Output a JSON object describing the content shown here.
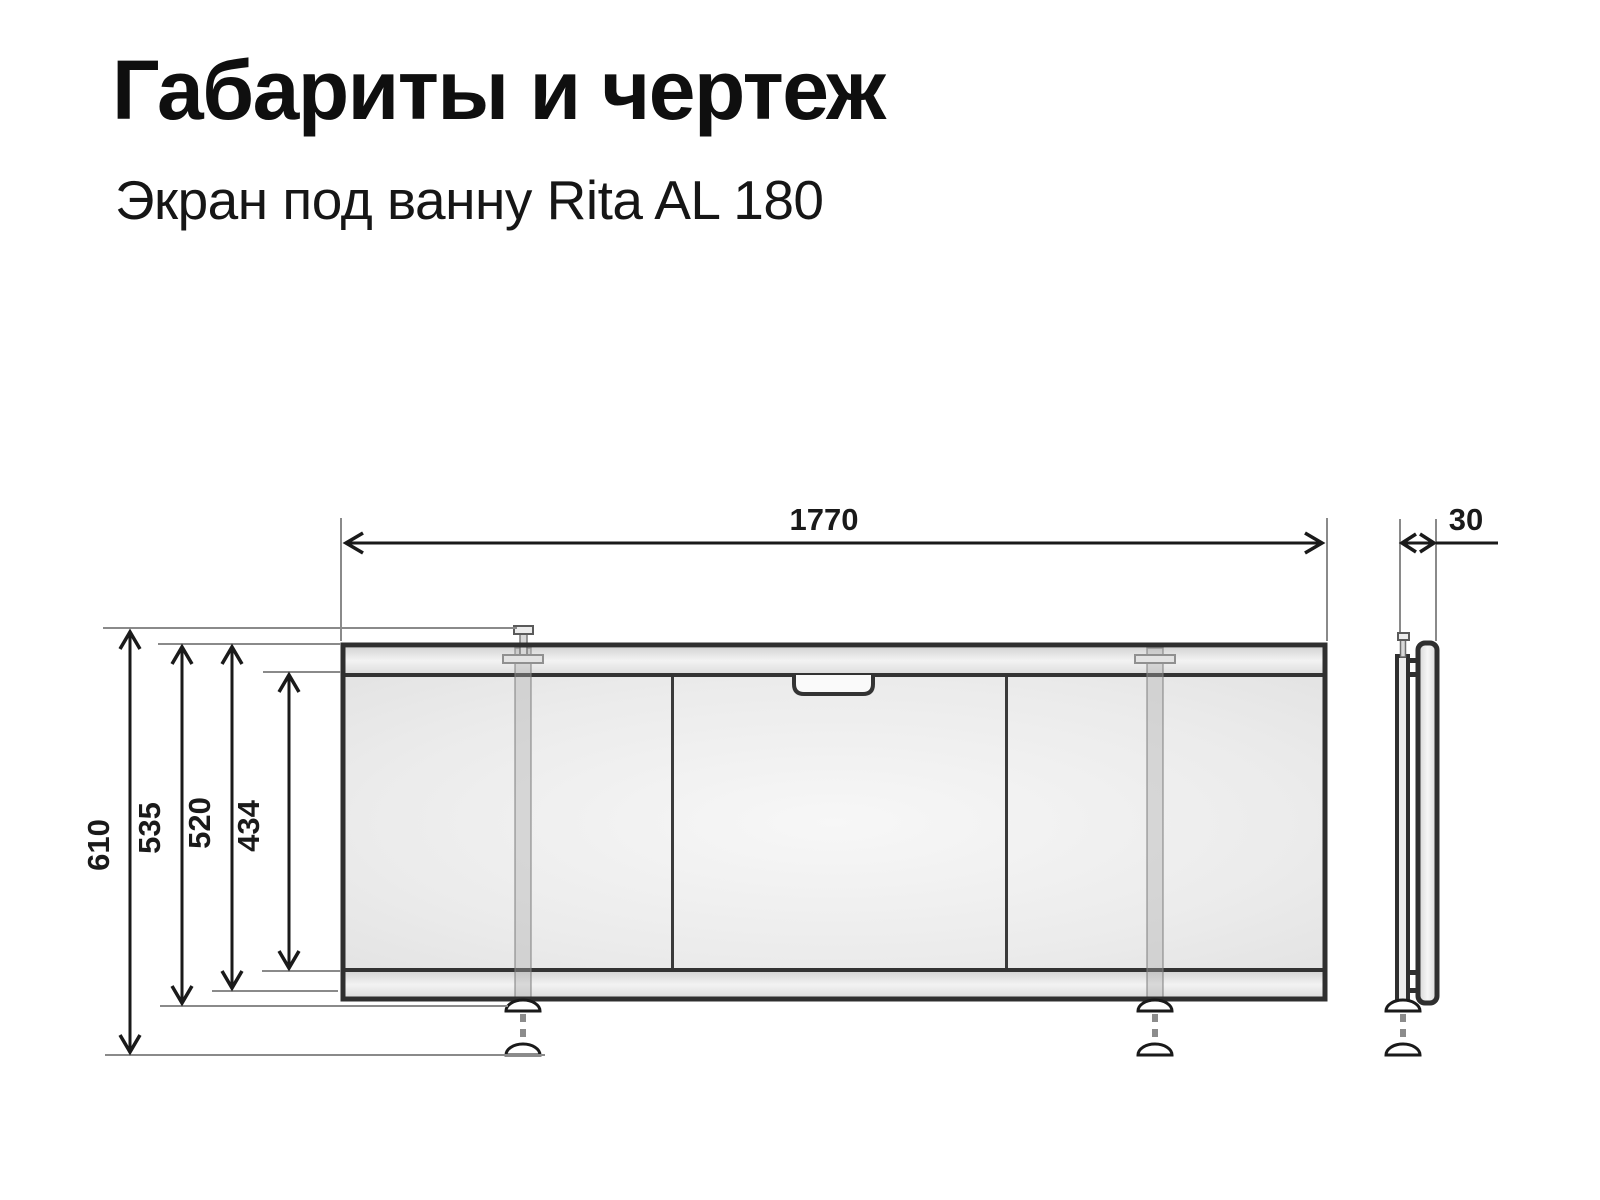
{
  "page": {
    "title": "Габариты и чертеж",
    "subtitle": "Экран под ванну Rita AL 180"
  },
  "dimensions": {
    "overall_width": "1770",
    "profile_depth": "30",
    "height_to_floor": "610",
    "height_overall": "535",
    "height_frame": "520",
    "panel_height": "434"
  },
  "colors": {
    "outline": "#2f2f2f",
    "dimension_lines": "#1a1a1a",
    "extension_lines": "#8a8a8a",
    "panel_fill": "#ebebeb",
    "text": "#0f0f0f",
    "background": "#ffffff"
  }
}
